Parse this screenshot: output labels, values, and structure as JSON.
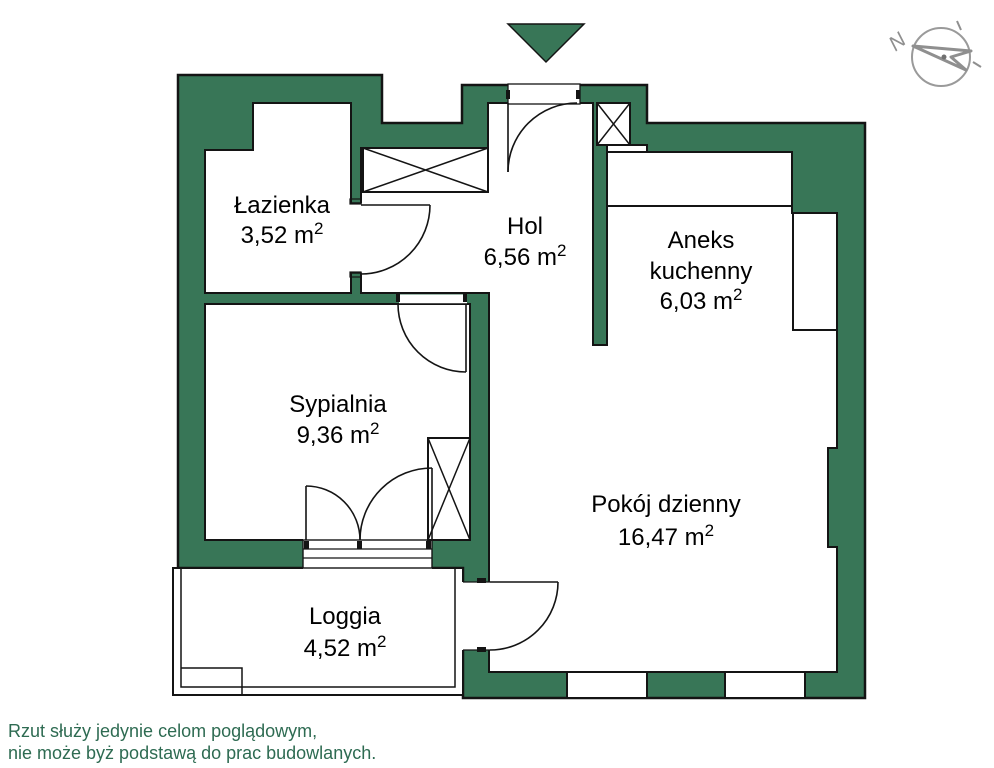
{
  "plan": {
    "rooms": [
      {
        "id": "lazienka",
        "name": "Łazienka",
        "area": "3,52 m",
        "sup": "2"
      },
      {
        "id": "hol",
        "name": "Hol",
        "area": "6,56 m",
        "sup": "2"
      },
      {
        "id": "aneks",
        "name": "Aneks",
        "name2": "kuchenny",
        "area": "6,03 m",
        "sup": "2"
      },
      {
        "id": "sypialnia",
        "name": "Sypialnia",
        "area": "9,36 m",
        "sup": "2"
      },
      {
        "id": "pokoj",
        "name": "Pokój dzienny",
        "area": "16,47 m",
        "sup": "2"
      },
      {
        "id": "loggia",
        "name": "Loggia",
        "area": "4,52 m",
        "sup": "2"
      }
    ]
  },
  "compass": {
    "north_label": "N"
  },
  "footer": {
    "line1": "Rzut służy jedynie celom poglądowym,",
    "line2": "nie może byż podstawą do prac budowlanych."
  },
  "colors": {
    "wall_green": "#387657",
    "outline": "#141414",
    "footer_green": "#2E6B52",
    "compass_gray": "#8f8f8f",
    "label_black": "#000000"
  }
}
